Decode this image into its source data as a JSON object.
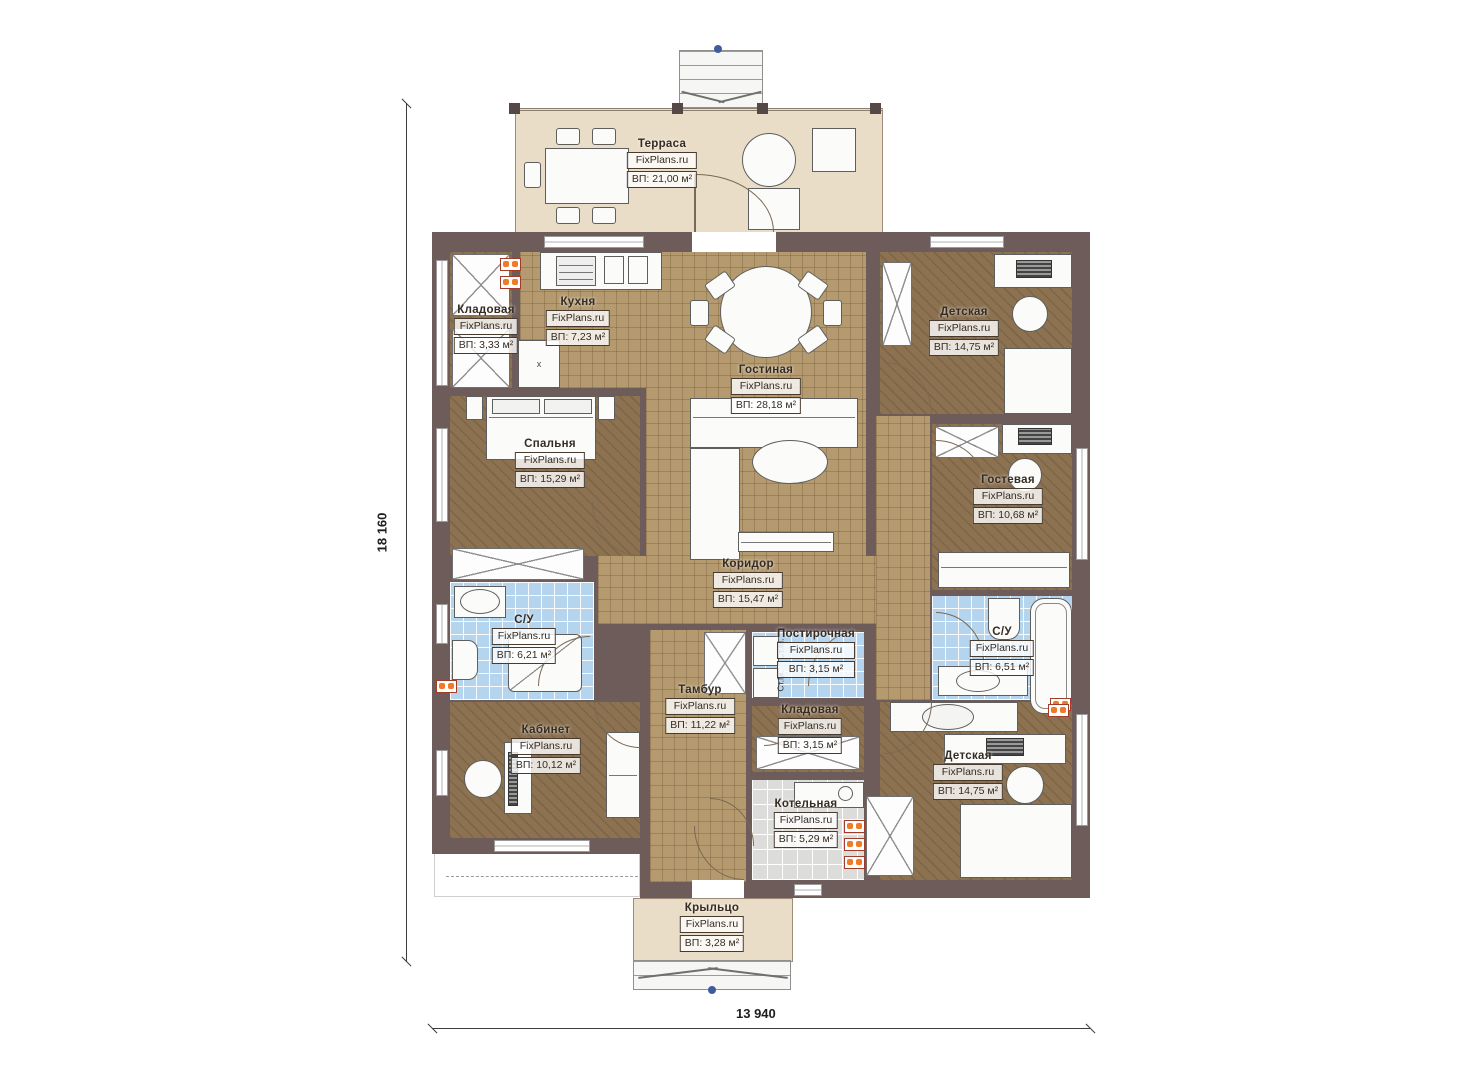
{
  "meta": {
    "brand": "FixPlans.ru",
    "plan_type": "floor-plan"
  },
  "dimensions": {
    "height_label": "18 160",
    "width_label": "13 940"
  },
  "annotations": {
    "washer_label": "Ст.М.",
    "kitchen_marker": "x"
  },
  "colors": {
    "wall": "#6e5c5b",
    "wood_light": "#b49a6e",
    "wood_dark": "#8c7251",
    "tile_blue": "#b5d4ee",
    "tile_gray": "#dcdcda",
    "terrace": "#e9ddc7",
    "radiator": "#f07a26",
    "marker_blue": "#3f5d9e"
  },
  "rooms": [
    {
      "id": "terrace",
      "name": "Терраса",
      "area": "ВП: 21,00 м²"
    },
    {
      "id": "kladovaya1",
      "name": "Кладовая",
      "area": "ВП: 3,33 м²"
    },
    {
      "id": "kitchen",
      "name": "Кухня",
      "area": "ВП: 7,23 м²"
    },
    {
      "id": "living",
      "name": "Гостиная",
      "area": "ВП: 28,18 м²"
    },
    {
      "id": "kids-top",
      "name": "Детская",
      "area": "ВП: 14,75 м²"
    },
    {
      "id": "bedroom",
      "name": "Спальня",
      "area": "ВП: 15,29 м²"
    },
    {
      "id": "guest",
      "name": "Гостевая",
      "area": "ВП: 10,68 м²"
    },
    {
      "id": "corridor",
      "name": "Коридор",
      "area": "ВП: 15,47 м²"
    },
    {
      "id": "su-left",
      "name": "С/У",
      "area": "ВП: 6,21 м²"
    },
    {
      "id": "laundry",
      "name": "Постирочная",
      "area": "ВП: 3,15 м²"
    },
    {
      "id": "su-right",
      "name": "С/У",
      "area": "ВП: 6,51 м²"
    },
    {
      "id": "tambur",
      "name": "Тамбур",
      "area": "ВП: 11,22 м²"
    },
    {
      "id": "kladovaya2",
      "name": "Кладовая",
      "area": "ВП: 3,15 м²"
    },
    {
      "id": "office",
      "name": "Кабинет",
      "area": "ВП: 10,12 м²"
    },
    {
      "id": "boiler",
      "name": "Котельная",
      "area": "ВП: 5,29 м²"
    },
    {
      "id": "kids-bottom",
      "name": "Детская",
      "area": "ВП: 14,75 м²"
    },
    {
      "id": "porch",
      "name": "Крыльцо",
      "area": "ВП: 3,28 м²"
    }
  ]
}
